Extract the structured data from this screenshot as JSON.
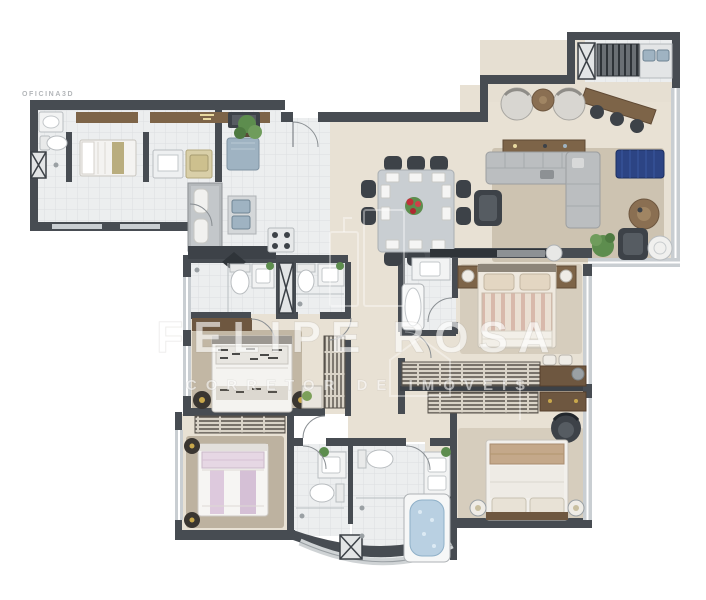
{
  "artwork": {
    "type": "apartment-floor-plan-3d-render",
    "view": "top-down",
    "background": "#ffffff"
  },
  "branding": {
    "studio_logo": "OFICINA3D",
    "watermark_title": "FELIPE ROSA",
    "watermark_subtitle": "CORRETOR DE IMÓVEIS"
  },
  "palette": {
    "wall": "#474c52",
    "wall_dark": "#3c4147",
    "floor_beige": "#e8e1d4",
    "floor_tile": "#eceeef",
    "tile_line": "#dcdfe1",
    "rug": "#cdc3b1",
    "rug_dark": "#bdb2a0",
    "wood": "#7d6448",
    "wood_dark": "#604a35",
    "sofa_gray": "#bbbec0",
    "chair_dark": "#3d4248",
    "accent_blue": "#2c4484",
    "accent_lavender": "#ddc9dd",
    "water_blue": "#b9d0e2",
    "appliance_blue": "#9fb3c2",
    "plant_green": "#5d8d4e",
    "window_glass": "#c9ced2",
    "watermark_white": "rgba(255,255,255,0.6)"
  },
  "rooms": [
    {
      "id": "service-area",
      "furniture": [
        "service-sink",
        "service-toilet",
        "utility-shaft",
        "maid-single-bed",
        "wall-shelf",
        "laundry-sink",
        "washing-machine"
      ]
    },
    {
      "id": "kitchen",
      "furniture": [
        "refrigerator",
        "wall-oven",
        "island-counter",
        "bar-stools",
        "double-sink",
        "cooktop",
        "dark-countertop",
        "decor-mat",
        "potted-plant"
      ]
    },
    {
      "id": "entry-hall",
      "furniture": [
        "entry-door"
      ]
    },
    {
      "id": "dining-room",
      "furniture": [
        "dining-table",
        "dining-chairs-x10",
        "flower-centerpiece",
        "place-settings"
      ]
    },
    {
      "id": "living-room",
      "furniture": [
        "area-rug",
        "wood-console",
        "sectional-sofa",
        "reading-armchair",
        "blue-daybed",
        "round-wood-pouf",
        "lounge-armchair",
        "floor-plant",
        "round-side-table",
        "tv-panel",
        "media-speaker"
      ]
    },
    {
      "id": "gourmet-terrace",
      "furniture": [
        "grill",
        "grill-counter-double-sink",
        "utility-panel",
        "bar-counter",
        "bar-stools-x3",
        "lounge-armchairs-x2",
        "round-coffee-table"
      ]
    },
    {
      "id": "bathroom-1",
      "furniture": [
        "shower-box",
        "toilet",
        "vanity-sink",
        "plant"
      ]
    },
    {
      "id": "bathroom-2",
      "furniture": [
        "toilet",
        "vanity-sink",
        "shower-box",
        "plant"
      ]
    },
    {
      "id": "bedroom-1",
      "furniture": [
        "wall-desk-shelf",
        "area-rug",
        "double-bed",
        "round-pouf-x2",
        "wardrobe",
        "study-desk"
      ]
    },
    {
      "id": "bedroom-2",
      "furniture": [
        "wardrobe",
        "area-rug",
        "double-bed-lavender",
        "round-pouf-x2"
      ]
    },
    {
      "id": "bathroom-3",
      "furniture": [
        "vanity-sink",
        "toilet",
        "shower-box",
        "plant"
      ]
    },
    {
      "id": "master-bathroom",
      "furniture": [
        "toilet",
        "vanity-sink",
        "double-shower",
        "jacuzzi-bathtub",
        "utility-shaft",
        "plant"
      ]
    },
    {
      "id": "ensuite-bathroom",
      "furniture": [
        "vanity-sink",
        "bathtub"
      ]
    },
    {
      "id": "master-bedroom",
      "furniture": [
        "area-rug",
        "double-bed-striped",
        "nightstand-x2",
        "table-lamps",
        "wardrobe-row",
        "poufs",
        "desk-with-chair"
      ]
    },
    {
      "id": "bedroom-3",
      "furniture": [
        "wardrobe-row",
        "wood-dresser",
        "armchair",
        "area-rug",
        "double-bed-tan",
        "table-lamps"
      ]
    },
    {
      "id": "corridor",
      "furniture": []
    }
  ]
}
